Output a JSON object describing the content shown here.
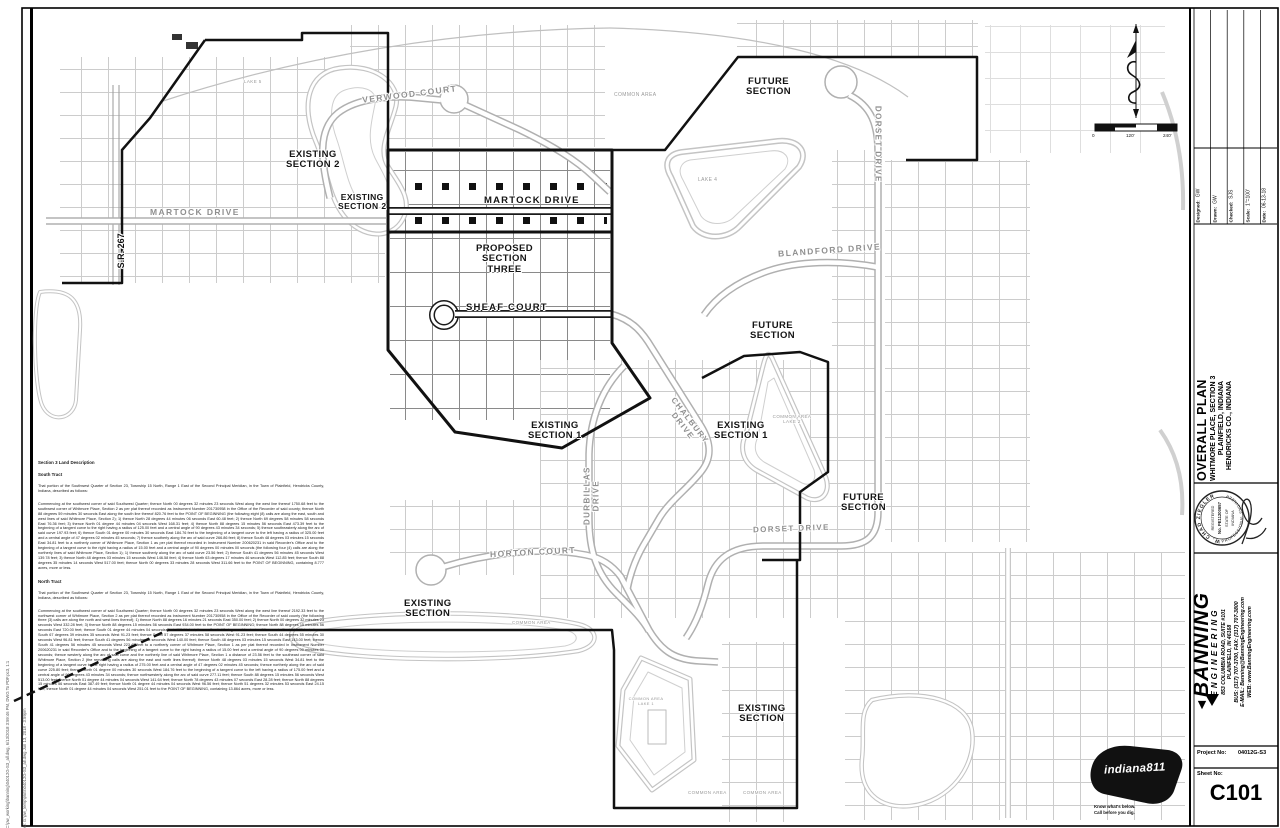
{
  "sheet": {
    "plot_stamp_line1": "C:\\pw_working\\banning\\04012G-S3_all.dwg, 6/13/2018 3:59:46 PM, DWG To PDF.pc3, 1:1",
    "plot_stamp_line2": "plotted: G:\\pw_temp\\plots\\04012G-S3_all.dwg    Jun 13, 2018 - 3:59pm",
    "scale_bar": {
      "zero": "0",
      "mid": "120'",
      "max": "240'"
    }
  },
  "map": {
    "streets": {
      "verwood": "VERWOOD COURT",
      "martock_existing": "MARTOCK DRIVE",
      "martock": "MARTOCK DRIVE",
      "sheaf": "SHEAF COURT",
      "chalbury": "CHALBURY DRIVE",
      "durbillas": "DURBILLAS DRIVE",
      "horton": "HORTON COURT",
      "dorset_east": "DORSET DRIVE",
      "dorset_south": "DORSET DRIVE",
      "blandford": "BLANDFORD DRIVE",
      "sr267": "S.R. 267"
    },
    "areas": {
      "existing_section_2a": "EXISTING\nSECTION 2",
      "existing_section_2b": "EXISTING\nSECTION 2",
      "proposed_section_three": "PROPOSED\nSECTION\nTHREE",
      "future_section_north": "FUTURE\nSECTION",
      "future_section_mid": "FUTURE\nSECTION",
      "future_section_south": "FUTURE\nSECTION",
      "existing_section_1a": "EXISTING\nSECTION 1",
      "existing_section_1b": "EXISTING\nSECTION 1",
      "existing_section_sw": "EXISTING\nSECTION",
      "existing_section_se": "EXISTING\nSECTION",
      "common_area_north": "COMMON AREA",
      "common_area_pond": "COMMON AREA",
      "common_area_s1": "COMMON AREA",
      "common_area_s2": "COMMON AREA",
      "lake1": "COMMON AREA\nLAKE 1",
      "lake2": "COMMON AREA\nLAKE 2",
      "lake4": "LAKE 4",
      "lake5": "LAKE 5"
    }
  },
  "land_description": {
    "heading": "Section 3 Land Description",
    "south_heading": "South Tract",
    "legal_intro": "That portion of the Southwest Quarter of Section 23, Township 15 North, Range 1 East of the Second Principal Meridian, in the Town of Plainfield, Hendricks County, Indiana, described as follows:",
    "south_body": "Commencing at the southwest corner of said Southwest Quarter; thence North 00 degrees 32 minutes 23 seconds West along the west line thereof 1750.68 feet to the southwest corner of Whitmore Place, Section 2 as per plat thereof recorded as Instrument Number 201730958 in the Office of the Recorder of said county; thence North 88 degrees 59 minutes 30 seconds East along the south line thereof 820.76 feet to the POINT OF BEGINNING (the following eight (8) calls are along the east, south and west lines of said Whitmore Place, Section 2); 1) thence North 28 degrees 44 minutes 06 seconds East 60.48 feet; 2) thence North 69 degrees 58 minutes 58 seconds East 76.36 feet; 3) thence North 01 degree 44 minutes 04 seconds West 168.31 feet; 4) thence North 88 degrees 15 minutes 56 seconds East 473.39 feet to the beginning of a tangent curve to the right having a radius of 125.00 feet and a central angle of 90 degrees 43 minutes 34 seconds; 5) thence southeasterly along the arc of said curve 197.93 feet; 6) thence South 01 degree 00 minutes 30 seconds East 184.76 feet to the beginning of a tangent curve to the left having a radius of 325.00 feet and a central angle of 47 degrees 02 minutes 45 seconds; 7) thence southerly along the arc of said curve 266.86 feet; 8) thence South 48 degrees 03 minutes 15 seconds East 34.81 feet to a northerly corner of Whitmore Place, Section 1 as per plat thereof recorded in Instrument Number 200620231 in said Recorder's Office and to the beginning of a tangent curve to the right having a radius of 15.00 feet and a central angle of 90 degrees 00 minutes 00 seconds (the following four (4) calls are along the northerly lines of said Whitmore Place, Section 1); 1) thence southerly along the arc of said curve 23.56 feet; 2) thence South 41 degrees 56 minutes 45 seconds West 139.78 feet; 3) thence North 48 degrees 03 minutes 15 seconds West 146.58 feet; 4) thence North 63 degrees 17 minutes 46 seconds West 112.85 feet; thence South 88 degrees 35 minutes 14 seconds West 517.00 feet; thence North 00 degrees 33 minutes 28 seconds West 311.66 feet to the POINT OF BEGINNING, containing 8.777 acres, more or less.",
    "north_heading": "North Tract",
    "north_body": "Commencing at the southwest corner of said Southwest Quarter; thence North 00 degrees 32 minutes 23 seconds West along the west line thereof 2192.33 feet to the northwest corner of Whitmore Place, Section 2 as per plat thereof recorded as Instrument Number 201730958 in the Office of the Recorder of said county (the following three (3) calls are along the north and west lines thereof); 1) thence North 88 degrees 16 minutes 21 seconds East 350.00 feet; 2) thence North 00 degrees 32 minutes 23 seconds West 332.28 feet; 3) thence North 88 degrees 15 minutes 56 seconds East 934.00 feet to the POINT OF BEGINNING; thence North 88 degrees 15 minutes 56 seconds East 720.00 feet; thence South 01 degree 44 minutes 04 seconds East 402.61 feet; thence South 17 degrees 19 minutes 37 seconds East 192.73 feet; thence South 67 degrees 39 minutes 35 seconds West 91.23 feet; thence South 57 degrees 37 minutes 58 seconds West 91.23 feet; thence South 44 degrees 55 minutes 30 seconds West 96.81 feet; thence South 41 degrees 56 minutes 45 seconds West 140.00 feet; thence South 48 degrees 03 minutes 15 seconds East 143.00 feet; thence South 41 degrees 56 minutes 45 seconds West 223.42 feet to a northerly corner of Whitmore Place, Section 1 as per plat thereof recorded in Instrument Number 200620231 in said Recorder's Office and to the beginning of a tangent curve to the right having a radius of 15.00 feet and a central angle of 90 degrees 00 minutes 00 seconds; thence westerly along the arc of said curve and the northerly line of said Whitmore Place, Section 1 a distance of 23.56 feet to the southeast corner of said Whitmore Place, Section 2 (the remaining calls are along the east and north lines thereof); thence North 48 degrees 03 minutes 15 seconds West 34.81 feet to the beginning of a tangent curve to the right having a radius of 275.00 feet and a central angle of 47 degrees 02 minutes 45 seconds; thence northerly along the arc of said curve 225.80 feet; thence North 01 degree 00 minutes 30 seconds West 184.76 feet to the beginning of a tangent curve to the left having a radius of 175.00 feet and a central angle of 90 degrees 43 minutes 34 seconds; thence northwesterly along the arc of said curve 277.11 feet; thence South 88 degrees 15 minutes 56 seconds West 513.00 feet; thence North 01 degree 44 minutes 04 seconds West 141.64 feet; thence North 78 degrees 43 minutes 07 seconds East 28.28 feet; thence North 88 degrees 15 minutes 56 seconds East 387.49 feet; thence North 01 degree 44 minutes 04 seconds West 96.56 feet; thence North 51 degrees 32 minutes 53 seconds East 24.15 feet; thence North 01 degree 44 minutes 04 seconds West 251.01 feet to the POINT OF BEGINNING, containing 13.864 acres, more or less."
  },
  "title_block": {
    "fields": [
      {
        "label": "Designed:",
        "value": "GW"
      },
      {
        "label": "Drawn:",
        "value": "GW"
      },
      {
        "label": "Checked:",
        "value": "SJS"
      },
      {
        "label": "Scale:",
        "value": "1\"=100'"
      },
      {
        "label": "Date:",
        "value": "06-13-18"
      }
    ],
    "titles": {
      "line1": "OVERALL PLAN",
      "line2": "WHITMORE PLACE, SECTION 3",
      "line3": "PLAINFIELD, INDIANA",
      "line4": "HENDRICKS CO., INDIANA"
    },
    "seal": {
      "name": "W. CHAD ZIEGLER",
      "registered": "REGISTERED",
      "number": "No. PE11200657",
      "state": "STATE OF",
      "indiana": "INDIANA",
      "title": "PROFESSIONAL ENGINEER"
    },
    "firm": {
      "name": "BANNING",
      "division": "ENGINEERING",
      "address": "853 COLUMBIA ROAD, SUITE #101",
      "city": "PLAINFIELD, IN 46168",
      "phone": "BUS: (317) 707-3700, FAX: (317) 707-3800",
      "email": "E-MAIL: Banning@BanningEngineering.com",
      "web": "WEB: www.BanningEngineering.com"
    },
    "project_no_label": "Project No:",
    "project_no": "04012G-S3",
    "sheet_no_label": "Sheet No:",
    "sheet_no": "C101"
  },
  "utility_logo": {
    "name": "indiana811",
    "taglines": "Know what's below.\nCall before you dig."
  }
}
